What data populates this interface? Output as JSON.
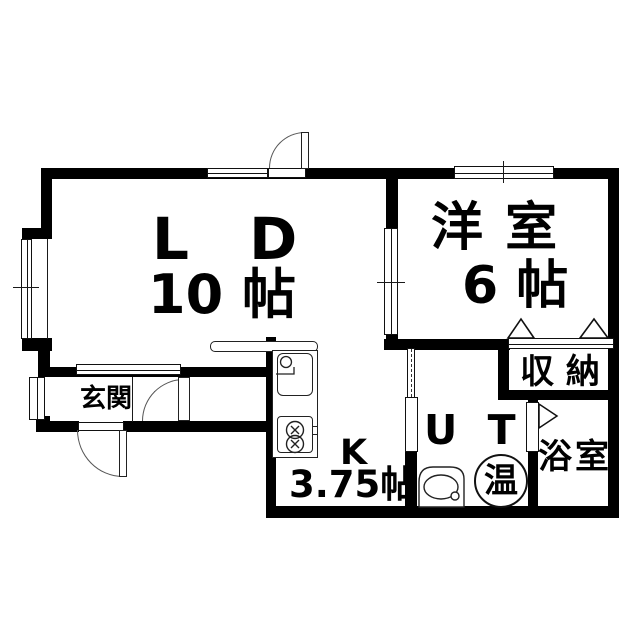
{
  "plan": {
    "rooms": {
      "ld": {
        "name": "L D",
        "size": "10 帖"
      },
      "western": {
        "name": "洋 室",
        "size": "6 帖"
      },
      "entrance": {
        "name": "玄関"
      },
      "kitchen": {
        "name": "K",
        "size": "3.75帖"
      },
      "utility": {
        "name": "U T"
      },
      "bath": {
        "name": "浴室"
      },
      "storage": {
        "name": "収 納"
      },
      "water_heater": {
        "label": "温"
      }
    },
    "colors": {
      "wall": "#000000",
      "background": "#ffffff",
      "line": "#1a1a1a"
    }
  }
}
